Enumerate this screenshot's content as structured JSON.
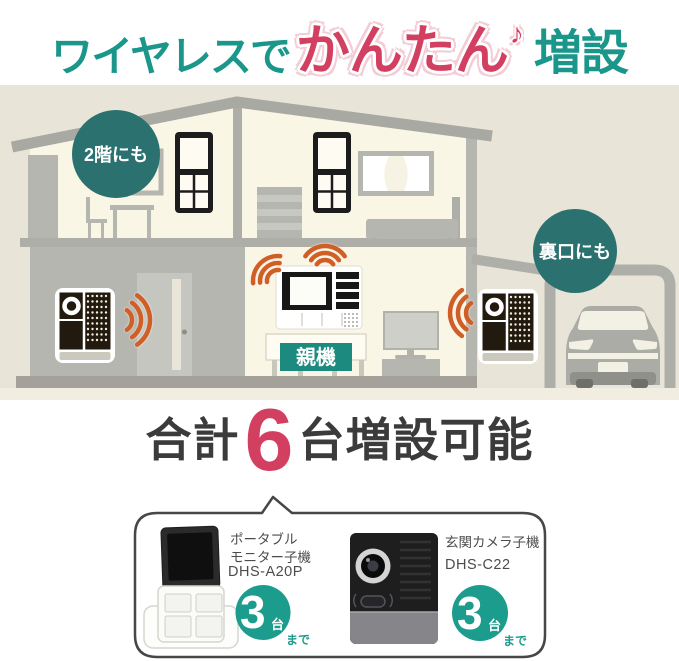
{
  "title": {
    "wireless": "ワイヤレスで",
    "easy": "かんたん",
    "note": "♪",
    "expand": "増設"
  },
  "house": {
    "floor2_badge": "2階にも",
    "backdoor_badge": "裏口にも",
    "main_unit": "親機"
  },
  "summary": {
    "total_label": "合計",
    "count": "6",
    "suffix": "台増設可能"
  },
  "products": {
    "monitor": {
      "name": "ポータブル\nモニター子機",
      "model": "DHS-A20P",
      "count": "3",
      "count_unit": "台",
      "count_suffix": "まで"
    },
    "camera": {
      "name": "玄関カメラ子機",
      "model": "DHS-C22",
      "count": "3",
      "count_unit": "台",
      "count_suffix": "まで"
    }
  },
  "colors": {
    "teal": "#1b968a",
    "teal_dark": "#2a7170",
    "crimson": "#d23f60",
    "orange": "#d05e27",
    "beige": "#e8e4d7",
    "cream": "#faf6e6"
  }
}
